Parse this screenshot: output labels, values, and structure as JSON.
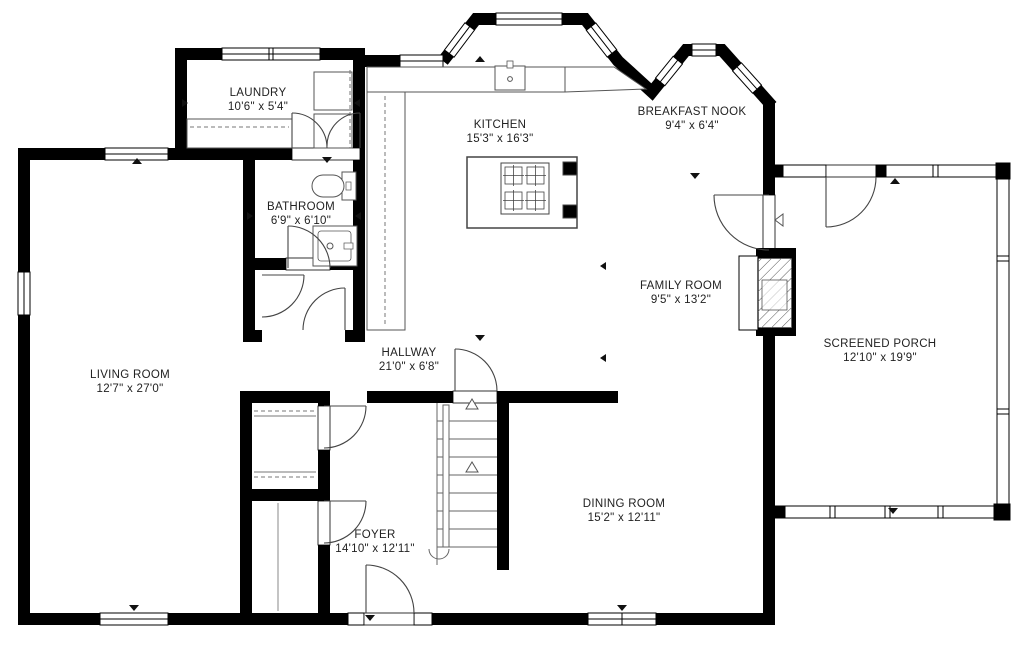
{
  "plan": {
    "background": "#ffffff",
    "wall_color": "#000000",
    "line_color": "#444444",
    "rooms": [
      {
        "id": "laundry",
        "name": "LAUNDRY",
        "dims": "10'6\" x 5'4\""
      },
      {
        "id": "kitchen",
        "name": "KITCHEN",
        "dims": "15'3\" x 16'3\""
      },
      {
        "id": "breakfast-nook",
        "name": "BREAKFAST NOOK",
        "dims": "9'4\" x 6'4\""
      },
      {
        "id": "bathroom",
        "name": "BATHROOM",
        "dims": "6'9\" x 6'10\""
      },
      {
        "id": "family-room",
        "name": "FAMILY ROOM",
        "dims": "9'5\" x 13'2\""
      },
      {
        "id": "screened-porch",
        "name": "SCREENED PORCH",
        "dims": "12'10\" x 19'9\""
      },
      {
        "id": "living-room",
        "name": "LIVING ROOM",
        "dims": "12'7\" x 27'0\""
      },
      {
        "id": "hallway",
        "name": "HALLWAY",
        "dims": "21'0\" x 6'8\""
      },
      {
        "id": "dining-room",
        "name": "DINING ROOM",
        "dims": "15'2\" x 12'11\""
      },
      {
        "id": "foyer",
        "name": "FOYER",
        "dims": "14'10\" x 12'11\""
      }
    ]
  }
}
